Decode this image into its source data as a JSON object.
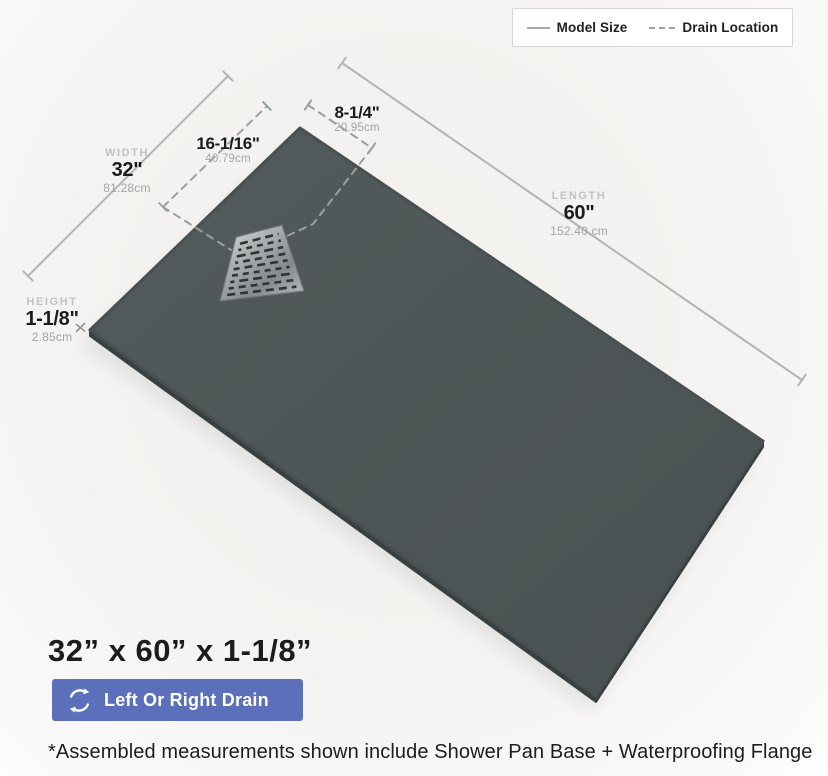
{
  "legend": {
    "model_size_label": "Model Size",
    "drain_location_label": "Drain Location"
  },
  "dimensions": {
    "width": {
      "name": "WIDTH",
      "value": "32\"",
      "metric": "81.28cm"
    },
    "length": {
      "name": "LENGTH",
      "value": "60\"",
      "metric": "152.40 cm"
    },
    "height": {
      "name": "HEIGHT",
      "value": "1-1/8\"",
      "metric": "2.85cm"
    },
    "drain_offset_width": {
      "value": "16-1/16\"",
      "metric": "40.79cm"
    },
    "drain_offset_length": {
      "value": "8-1/4\"",
      "metric": "20.95cm"
    }
  },
  "summary": {
    "size_text": "32” x 60” x 1-1/8”",
    "drain_badge_label": "Left Or Right Drain"
  },
  "footnote": "*Assembled measurements shown include Shower Pan Base + Waterproofing Flange",
  "colors": {
    "pan_surface": "#4e5556",
    "pan_side": "#394041",
    "badge_blue": "#5b6fba",
    "model_size_line": "#b3b3b3",
    "drain_location_line": "#98a0a4"
  }
}
